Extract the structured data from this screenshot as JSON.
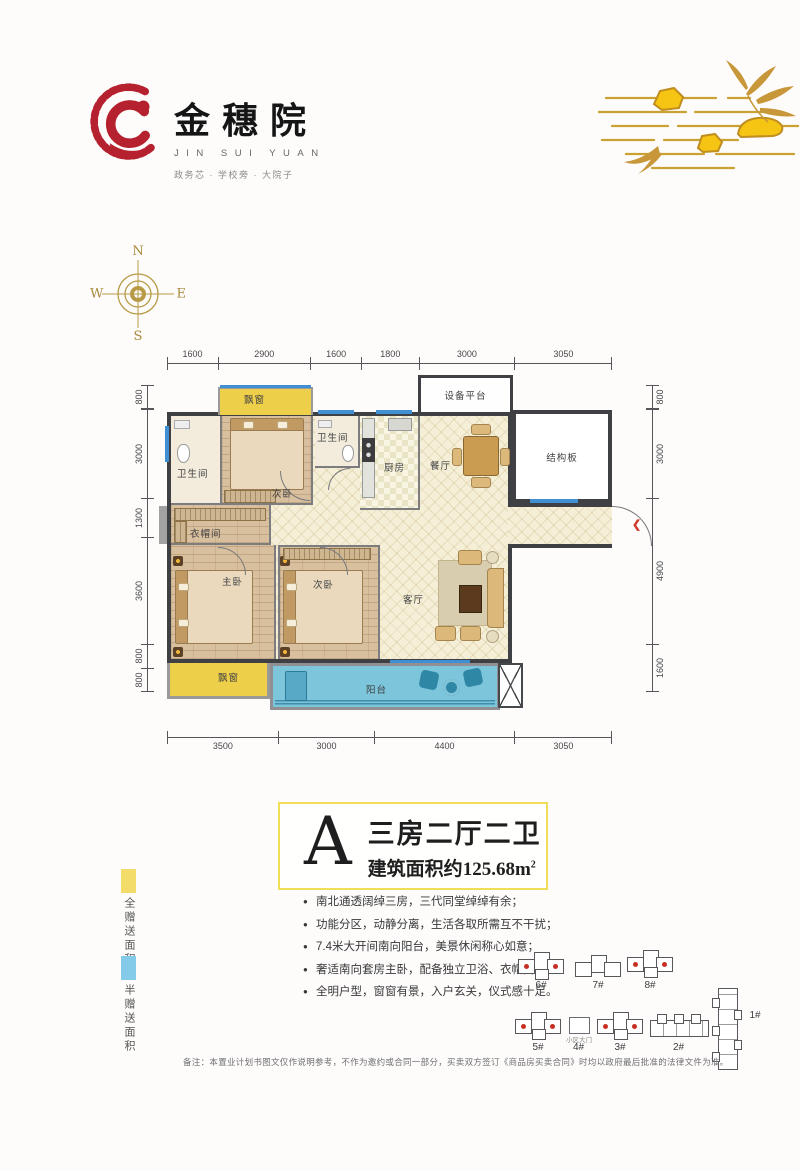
{
  "brand": {
    "name_cn": "金穗院",
    "name_en": "JIN SUI YUAN",
    "tagline": "政务芯 · 学校旁 · 大院子"
  },
  "compass": {
    "n": "N",
    "e": "E",
    "s": "S",
    "w": "W"
  },
  "floorplan": {
    "dims_top": [
      "1600",
      "2900",
      "1600",
      "1800",
      "3000",
      "3050"
    ],
    "dims_bottom": [
      "3500",
      "3000",
      "4400",
      "3050"
    ],
    "dims_left": [
      "800",
      "3000",
      "1300",
      "3600",
      "800",
      "800"
    ],
    "dims_right": [
      "800",
      "3000",
      "4900",
      "1600"
    ],
    "rooms": {
      "bay_window_top": "飘窗",
      "equipment_platform": "设备平台",
      "bathroom_left": "卫生间",
      "bedroom_top": "次卧",
      "bathroom_mid": "卫生间",
      "kitchen": "厨房",
      "dining_room": "餐厅",
      "structural_slab": "结构板",
      "cloakroom": "衣帽间",
      "master_bedroom": "主卧",
      "bedroom_second": "次卧",
      "living_room": "客厅",
      "balcony": "阳台",
      "bay_window_bottom": "飘窗"
    },
    "entry_arrow": "❮"
  },
  "unit": {
    "letter": "A",
    "layout": "三房二厅二卫",
    "area_prefix": "建筑面积约",
    "area_value": "125.68m",
    "area_sup": "2"
  },
  "legend": [
    {
      "label": "全赠送面积",
      "color": "#f3dc69"
    },
    {
      "label": "半赠送面积",
      "color": "#84cbe9"
    }
  ],
  "features": [
    "南北通透阔绰三房，三代同堂绰绰有余；",
    "功能分区，动静分离，生活各取所需互不干扰；",
    "7.4米大开间南向阳台，美景休闲称心如意；",
    "奢适南向套房主卧，配备独立卫浴、衣帽间；",
    "全明户型，窗窗有景，入户玄关，仪式感十足。"
  ],
  "sitemap": {
    "labels": [
      "6#",
      "7#",
      "8#",
      "5#",
      "4#",
      "3#",
      "2#",
      "1#"
    ],
    "gate": "小区大门"
  },
  "disclaimer": "备注：本置业计划书图文仅作说明参考，不作为邀约或合同一部分，买卖双方签订《商品房买卖合同》时均以政府最后批准的法律文件为准。",
  "colors": {
    "brand_red": "#b5212f",
    "gold": "#c9a233",
    "wall_dark": "#3f4044",
    "bay_yellow": "#eecf4a",
    "balcony_blue": "#7cc5da"
  }
}
